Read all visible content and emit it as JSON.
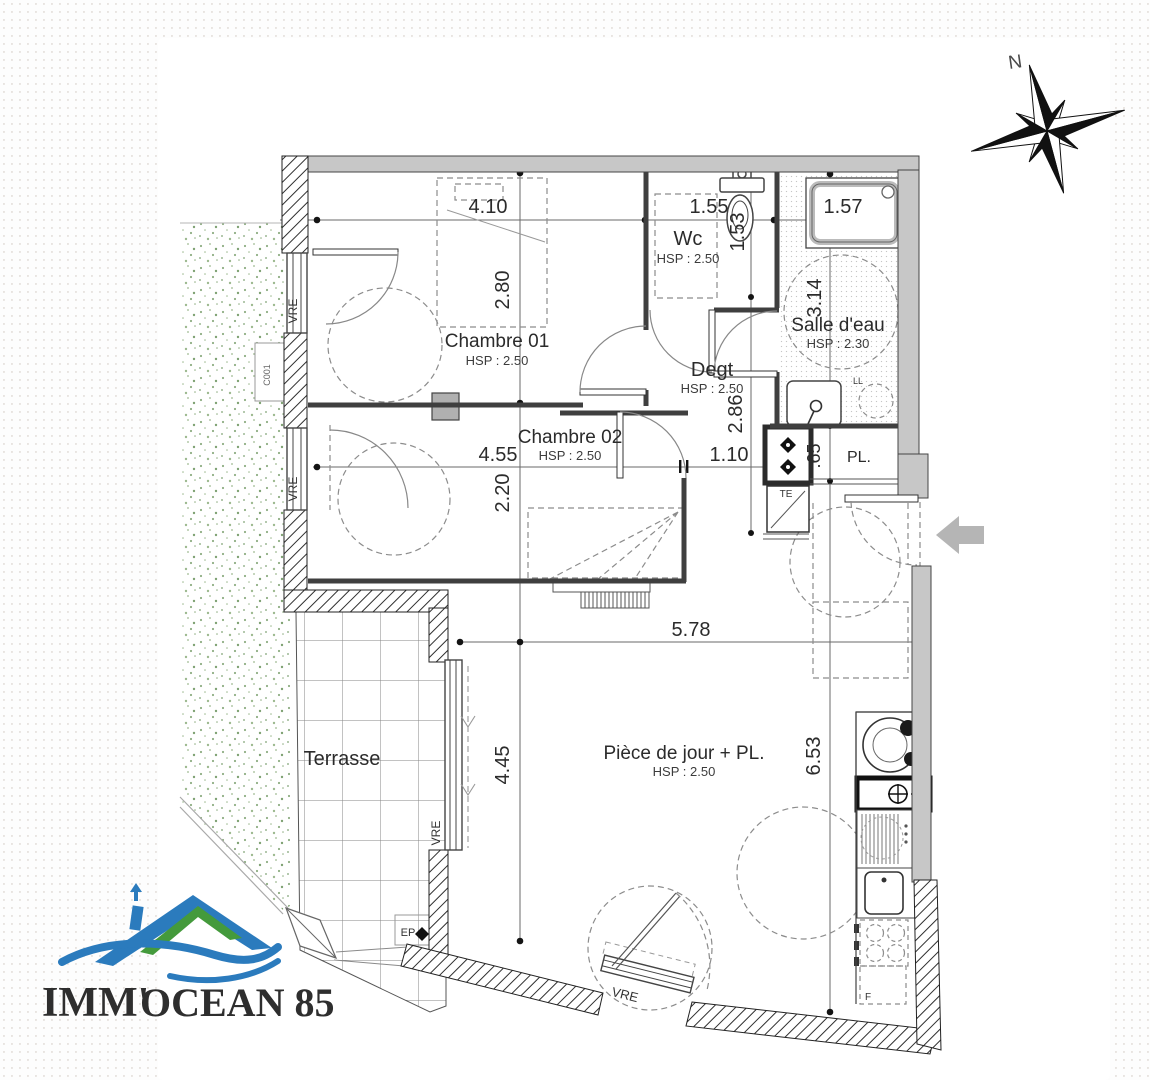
{
  "plan": {
    "rooms": {
      "chambre01": {
        "name": "Chambre 01",
        "hsp": "HSP : 2.50"
      },
      "chambre02": {
        "name": "Chambre 02",
        "hsp": "HSP : 2.50"
      },
      "wc": {
        "name": "Wc",
        "hsp": "HSP : 2.50"
      },
      "salle_eau": {
        "name": "Salle d'eau",
        "hsp": "HSP : 2.30"
      },
      "degt": {
        "name": "Degt",
        "hsp": "HSP : 2.50"
      },
      "piece_de_jour": {
        "name": "Pièce de jour + PL.",
        "hsp": "HSP : 2.50"
      },
      "pl": {
        "name": "PL."
      },
      "terrasse": {
        "name": "Terrasse"
      }
    },
    "dimensions": {
      "chambre01_width": "4.10",
      "wc_width": "1.55",
      "shower_width": "1.57",
      "chambre01_depth": "2.80",
      "wc_depth": "1.53",
      "salle_eau_depth": "3.14",
      "degt_depth": "2.86",
      "chambre02_width": "4.55",
      "hall_width": "1.10",
      "pl_depth": ".65",
      "chambre02_depth": "2.20",
      "living_width": "5.78",
      "living_depth": "4.45",
      "kitchen_wall": "6.53"
    },
    "annotations": {
      "window": "VRE",
      "technical": "TE",
      "rainwater": "EP",
      "fridge": "F",
      "washer": "LL",
      "ref": "C001"
    }
  },
  "compass": {
    "north": "N"
  },
  "logo": {
    "text_green": "IMM'",
    "text_blue": "OCEAN 85",
    "color_green": "#449a3c",
    "color_blue": "#2b7bbd"
  }
}
